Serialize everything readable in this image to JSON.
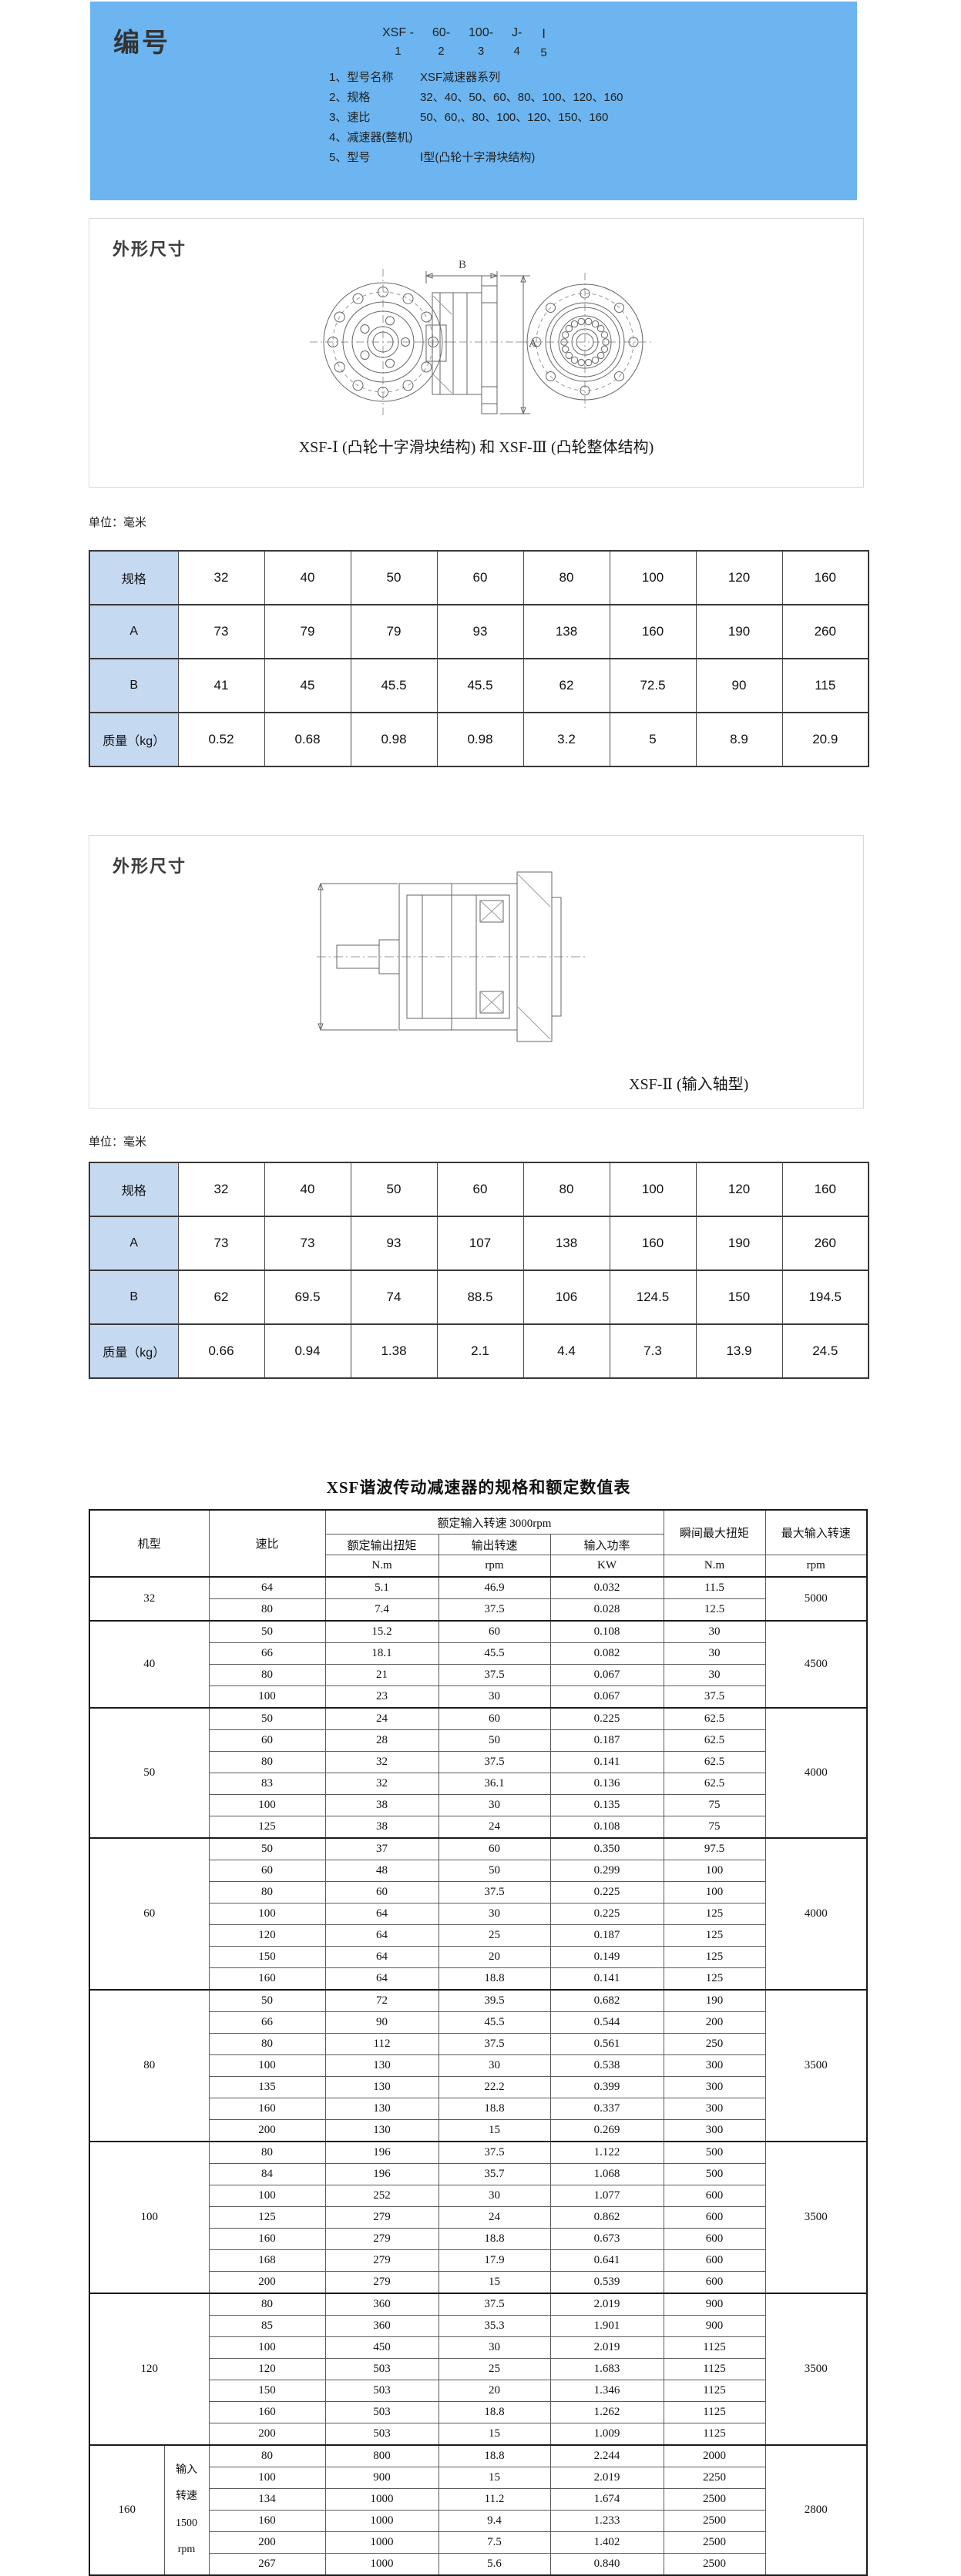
{
  "colors": {
    "header_bg": "#6cb5f0",
    "spec_header_bg": "#c5d9f1"
  },
  "numbering": {
    "title": "编号",
    "code_segments": [
      {
        "text": "XSF -",
        "num": "1"
      },
      {
        "text": "60-",
        "num": "2"
      },
      {
        "text": "100-",
        "num": "3"
      },
      {
        "text": "J-",
        "num": "4"
      },
      {
        "text": "Ⅰ",
        "num": "5"
      }
    ],
    "items": [
      {
        "no": "1、",
        "label": "型号名称",
        "value": "XSF减速器系列"
      },
      {
        "no": "2、",
        "label": "规格",
        "value": "32、40、50、60、80、100、120、160"
      },
      {
        "no": "3、",
        "label": "速比",
        "value": "50、60,、80、100、120、150、160"
      },
      {
        "no": "4、",
        "label": "减速器(整机)",
        "value": ""
      },
      {
        "no": "5、",
        "label": "型号",
        "value": "Ⅰ型(凸轮十字滑块结构)"
      }
    ]
  },
  "sections": [
    {
      "heading": "外形尺寸",
      "caption": "XSF-Ⅰ (凸轮十字滑块结构) 和 XSF-Ⅲ (凸轮整体结构)",
      "dim_width_label": "B",
      "dim_height_label": "A"
    },
    {
      "heading": "外形尺寸",
      "caption": "XSF-Ⅱ (输入轴型)"
    }
  ],
  "unit_note": "单位：毫米",
  "spec_tables": [
    {
      "header": [
        "规格",
        "32",
        "40",
        "50",
        "60",
        "80",
        "100",
        "120",
        "160"
      ],
      "rows": [
        [
          "A",
          "73",
          "79",
          "79",
          "93",
          "138",
          "160",
          "190",
          "260"
        ],
        [
          "B",
          "41",
          "45",
          "45.5",
          "45.5",
          "62",
          "72.5",
          "90",
          "115"
        ],
        [
          "质量（kg）",
          "0.52",
          "0.68",
          "0.98",
          "0.98",
          "3.2",
          "5",
          "8.9",
          "20.9"
        ]
      ]
    },
    {
      "header": [
        "规格",
        "32",
        "40",
        "50",
        "60",
        "80",
        "100",
        "120",
        "160"
      ],
      "rows": [
        [
          "A",
          "73",
          "73",
          "93",
          "107",
          "138",
          "160",
          "190",
          "260"
        ],
        [
          "B",
          "62",
          "69.5",
          "74",
          "88.5",
          "106",
          "124.5",
          "150",
          "194.5"
        ],
        [
          "质量（kg）",
          "0.66",
          "0.94",
          "1.38",
          "2.1",
          "4.4",
          "7.3",
          "13.9",
          "24.5"
        ]
      ]
    }
  ],
  "rating_table": {
    "title": "XSF谐波传动减速器的规格和额定数值表",
    "col_headers": {
      "model": "机型",
      "ratio": "速比",
      "rated_group": "额定输入转速 3000rpm",
      "rated_cols": [
        "额定输出扭矩",
        "输出转速",
        "输入功率"
      ],
      "rated_units": [
        "N.m",
        "rpm",
        "KW"
      ],
      "peak_torque": "瞬间最大扭矩",
      "peak_torque_unit": "N.m",
      "max_input_speed": "最大输入转速",
      "max_input_speed_unit": "rpm"
    },
    "sections": [
      {
        "model": "32",
        "max_speed": "5000",
        "rows": [
          [
            "64",
            "5.1",
            "46.9",
            "0.032",
            "11.5"
          ],
          [
            "80",
            "7.4",
            "37.5",
            "0.028",
            "12.5"
          ]
        ]
      },
      {
        "model": "40",
        "max_speed": "4500",
        "rows": [
          [
            "50",
            "15.2",
            "60",
            "0.108",
            "30"
          ],
          [
            "66",
            "18.1",
            "45.5",
            "0.082",
            "30"
          ],
          [
            "80",
            "21",
            "37.5",
            "0.067",
            "30"
          ],
          [
            "100",
            "23",
            "30",
            "0.067",
            "37.5"
          ]
        ]
      },
      {
        "model": "50",
        "max_speed": "4000",
        "rows": [
          [
            "50",
            "24",
            "60",
            "0.225",
            "62.5"
          ],
          [
            "60",
            "28",
            "50",
            "0.187",
            "62.5"
          ],
          [
            "80",
            "32",
            "37.5",
            "0.141",
            "62.5"
          ],
          [
            "83",
            "32",
            "36.1",
            "0.136",
            "62.5"
          ],
          [
            "100",
            "38",
            "30",
            "0.135",
            "75"
          ],
          [
            "125",
            "38",
            "24",
            "0.108",
            "75"
          ]
        ]
      },
      {
        "model": "60",
        "max_speed": "4000",
        "rows": [
          [
            "50",
            "37",
            "60",
            "0.350",
            "97.5"
          ],
          [
            "60",
            "48",
            "50",
            "0.299",
            "100"
          ],
          [
            "80",
            "60",
            "37.5",
            "0.225",
            "100"
          ],
          [
            "100",
            "64",
            "30",
            "0.225",
            "125"
          ],
          [
            "120",
            "64",
            "25",
            "0.187",
            "125"
          ],
          [
            "150",
            "64",
            "20",
            "0.149",
            "125"
          ],
          [
            "160",
            "64",
            "18.8",
            "0.141",
            "125"
          ]
        ]
      },
      {
        "model": "80",
        "max_speed": "3500",
        "rows": [
          [
            "50",
            "72",
            "39.5",
            "0.682",
            "190"
          ],
          [
            "66",
            "90",
            "45.5",
            "0.544",
            "200"
          ],
          [
            "80",
            "112",
            "37.5",
            "0.561",
            "250"
          ],
          [
            "100",
            "130",
            "30",
            "0.538",
            "300"
          ],
          [
            "135",
            "130",
            "22.2",
            "0.399",
            "300"
          ],
          [
            "160",
            "130",
            "18.8",
            "0.337",
            "300"
          ],
          [
            "200",
            "130",
            "15",
            "0.269",
            "300"
          ]
        ]
      },
      {
        "model": "100",
        "max_speed": "3500",
        "rows": [
          [
            "80",
            "196",
            "37.5",
            "1.122",
            "500"
          ],
          [
            "84",
            "196",
            "35.7",
            "1.068",
            "500"
          ],
          [
            "100",
            "252",
            "30",
            "1.077",
            "600"
          ],
          [
            "125",
            "279",
            "24",
            "0.862",
            "600"
          ],
          [
            "160",
            "279",
            "18.8",
            "0.673",
            "600"
          ],
          [
            "168",
            "279",
            "17.9",
            "0.641",
            "600"
          ],
          [
            "200",
            "279",
            "15",
            "0.539",
            "600"
          ]
        ]
      },
      {
        "model": "120",
        "max_speed": "3500",
        "rows": [
          [
            "80",
            "360",
            "37.5",
            "2.019",
            "900"
          ],
          [
            "85",
            "360",
            "35.3",
            "1.901",
            "900"
          ],
          [
            "100",
            "450",
            "30",
            "2.019",
            "1125"
          ],
          [
            "120",
            "503",
            "25",
            "1.683",
            "1125"
          ],
          [
            "150",
            "503",
            "20",
            "1.346",
            "1125"
          ],
          [
            "160",
            "503",
            "18.8",
            "1.262",
            "1125"
          ],
          [
            "200",
            "503",
            "15",
            "1.009",
            "1125"
          ]
        ]
      },
      {
        "model": "160",
        "max_speed": "2800",
        "sub_label": [
          "输入",
          "转速",
          "1500",
          "rpm"
        ],
        "rows": [
          [
            "80",
            "800",
            "18.8",
            "2.244",
            "2000"
          ],
          [
            "100",
            "900",
            "15",
            "2.019",
            "2250"
          ],
          [
            "134",
            "1000",
            "11.2",
            "1.674",
            "2500"
          ],
          [
            "160",
            "1000",
            "9.4",
            "1.233",
            "2500"
          ],
          [
            "200",
            "1000",
            "7.5",
            "1.402",
            "2500"
          ],
          [
            "267",
            "1000",
            "5.6",
            "0.840",
            "2500"
          ]
        ]
      }
    ]
  }
}
